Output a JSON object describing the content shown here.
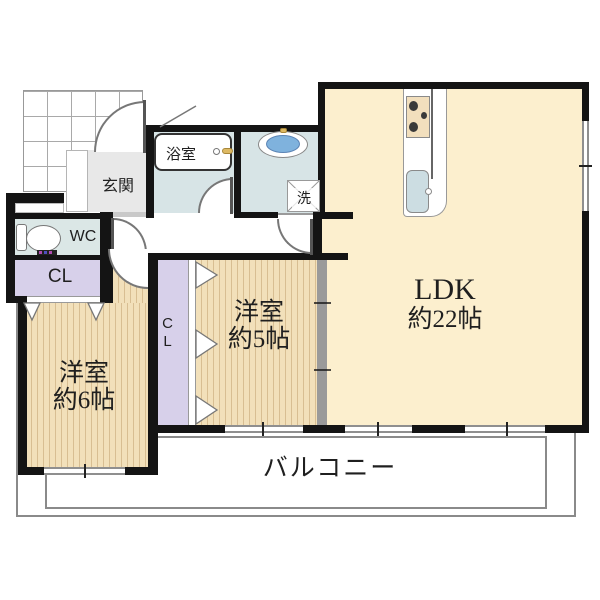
{
  "plan": {
    "type": "floorplan",
    "rooms": {
      "ldk": {
        "label": "LDK",
        "size": "約22帖",
        "color": "#fcefce"
      },
      "bedroom5": {
        "label": "洋室",
        "size": "約5帖",
        "color": "#f2e0ba"
      },
      "bedroom6": {
        "label": "洋室",
        "size": "約6帖",
        "color": "#f2e0ba"
      },
      "balcony": {
        "label": "バルコニー"
      },
      "entrance": {
        "label": "玄関",
        "color": "#e8e8e8"
      },
      "bathroom": {
        "label": "浴室",
        "color": "#d7e4e6"
      },
      "washroom": {
        "color": "#d7e4e6"
      },
      "toilet_room": {
        "label": "WC",
        "color": "#dbe7e6"
      },
      "closet_hall": {
        "label": "CL",
        "color": "#d7d0ea"
      },
      "closet_inner": {
        "label": "CL",
        "color": "#d7d0ea"
      },
      "laundry": {
        "label": "洗"
      }
    },
    "fixtures": [
      "bathtub",
      "washbasin",
      "toilet",
      "washing-machine-pan",
      "kitchen-counter",
      "stove",
      "kitchen-sink",
      "entrance-porch-tile"
    ],
    "colors": {
      "wall": "#141414",
      "window_glass": "#8f8f8f",
      "balcony_line": "#8a8a8a",
      "wood_stripe": "#d8be92",
      "basin_water": "#7fb2dd",
      "kitchen_sink": "#ccdde2",
      "faucet": "#ddb963"
    }
  }
}
